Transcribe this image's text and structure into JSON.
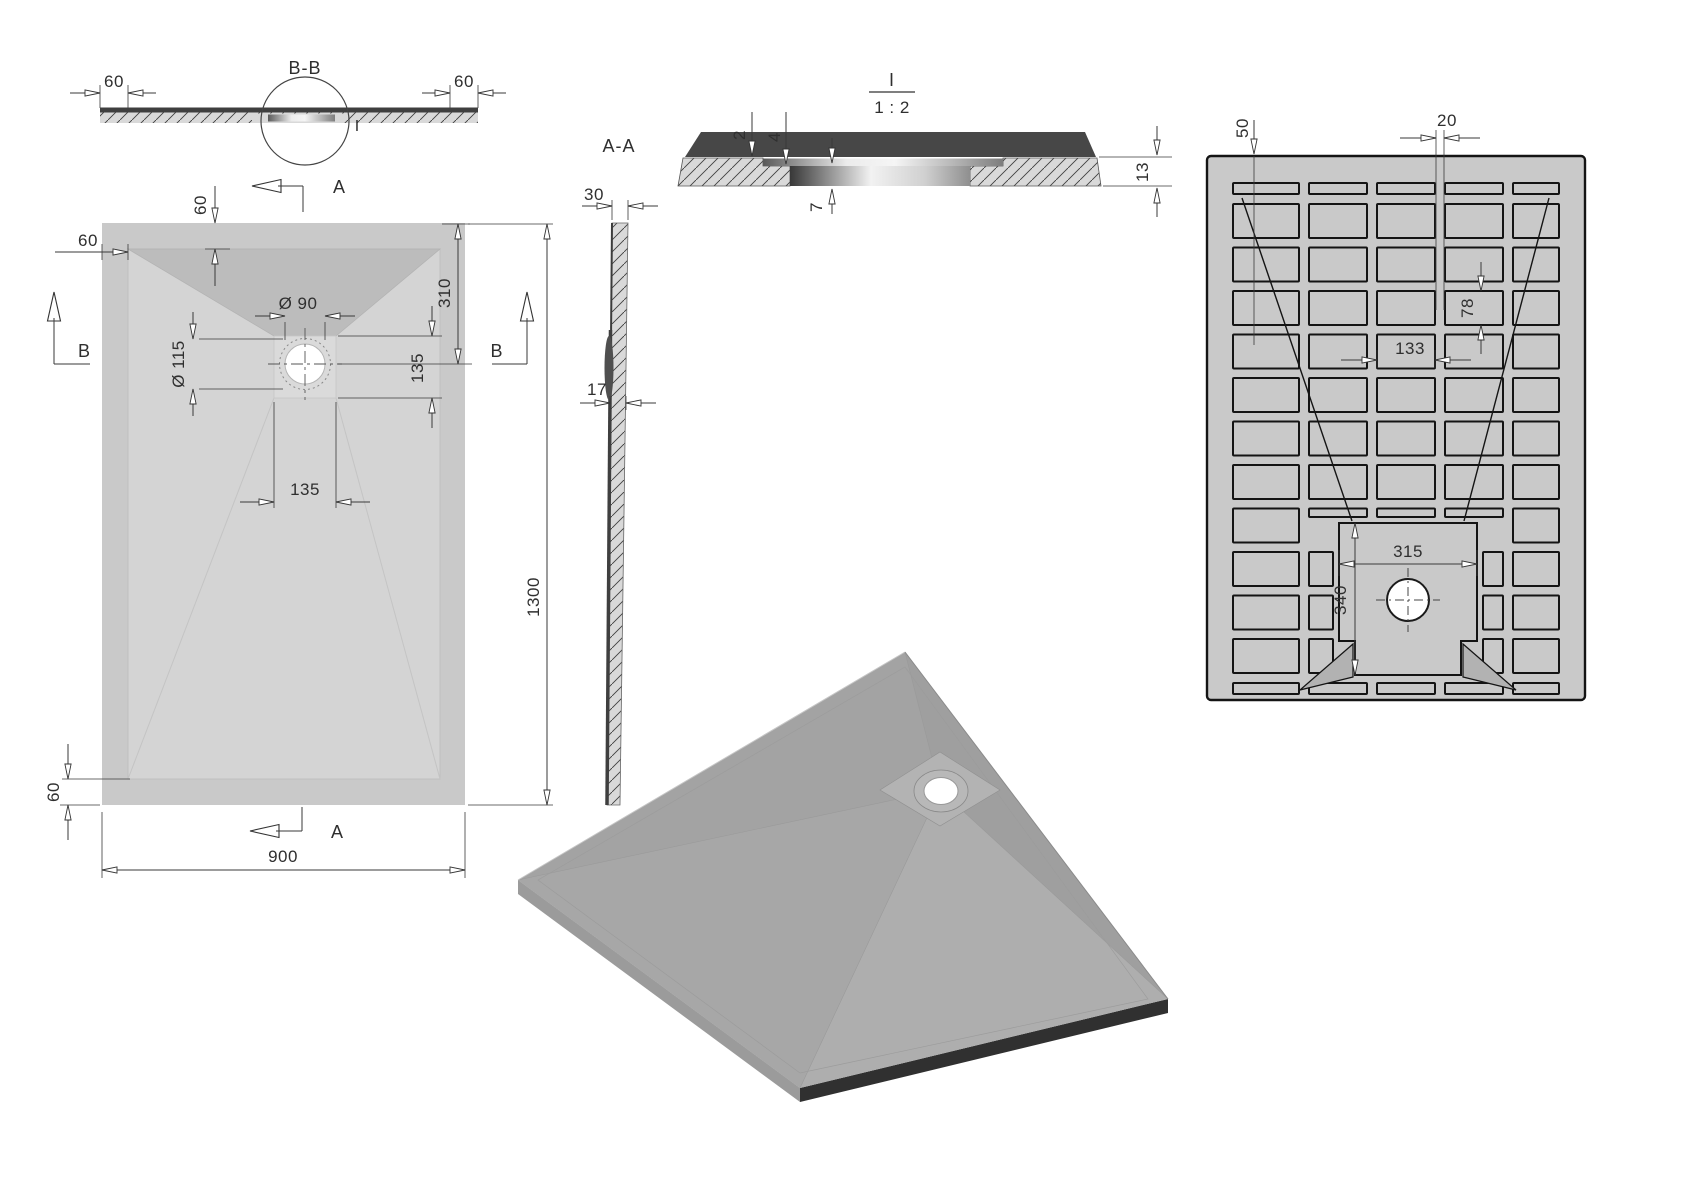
{
  "views": {
    "bb": {
      "title": "B-B",
      "detail_mark": "I",
      "dim_left": "60",
      "dim_right": "60"
    },
    "plan": {
      "cut_a_top": "A",
      "cut_a_bottom": "A",
      "cut_b_left": "B",
      "cut_b_right": "B",
      "dim_border_left": "60",
      "dim_border_top": "60",
      "dim_drain_outer": "Ø 90",
      "dim_drain_inner": "Ø 115",
      "dim_drain_top": "310",
      "dim_drain_side": "135",
      "dim_drain_below": "135",
      "dim_border_bottom": "60",
      "dim_width": "900",
      "dim_length": "1300"
    },
    "aa": {
      "title": "A-A",
      "dim_edge": "30",
      "dim_center": "17"
    },
    "detail": {
      "title": "I",
      "scale": "1 : 2",
      "dim_lip": "2",
      "dim_step": "4",
      "dim_depth": "7",
      "dim_thickness": "13"
    },
    "bottom": {
      "dim_edge": "50",
      "dim_rib": "20",
      "dim_pitch": "78",
      "dim_pocket": "133",
      "dim_center_w": "315",
      "dim_center_h": "340"
    }
  }
}
